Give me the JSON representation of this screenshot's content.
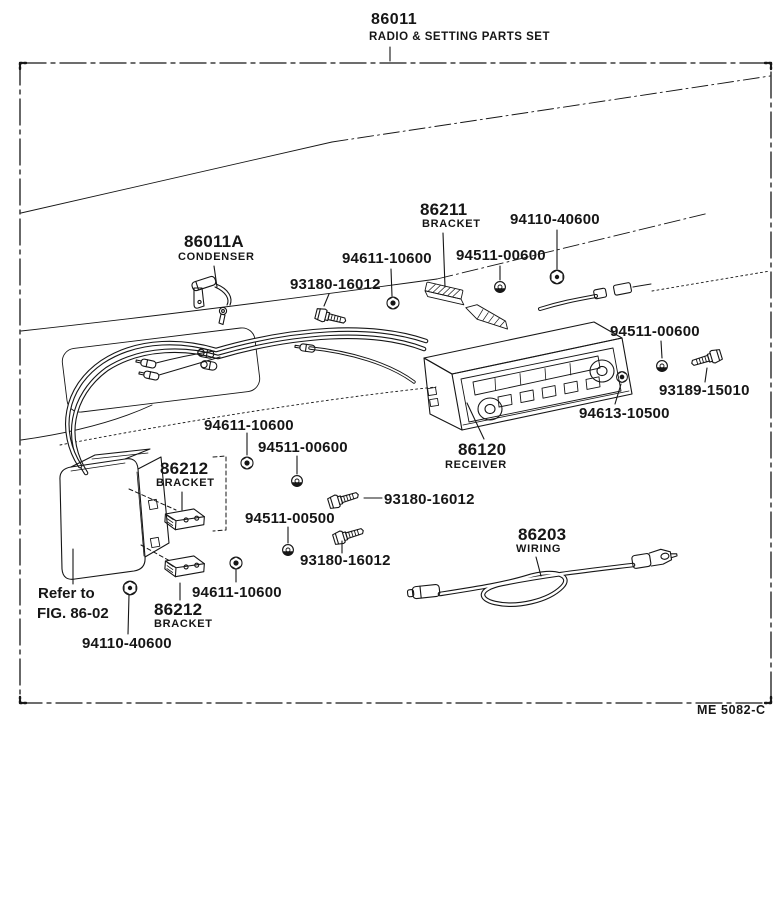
{
  "title": {
    "part_number": "86011",
    "description": "RADIO & SETTING PARTS SET"
  },
  "note": {
    "line1": "Refer to",
    "line2": "FIG. 86-02"
  },
  "drawing_code": "ME 5082-C",
  "callouts": {
    "condenser": {
      "part_number": "86011A",
      "caption": "CONDENSER"
    },
    "bracket_upper": {
      "part_number": "86211",
      "caption": "BRACKET"
    },
    "nut_upper_94110": {
      "part_number": "94110-40600"
    },
    "nut_upper_94611": {
      "part_number": "94611-10600"
    },
    "screw_upper_94511": {
      "part_number": "94511-00600"
    },
    "bolt_upper_93180": {
      "part_number": "93180-16012"
    },
    "screw_right_94511": {
      "part_number": "94511-00600"
    },
    "bolt_right_93189": {
      "part_number": "93189-15010"
    },
    "nut_right_94613": {
      "part_number": "94613-10500"
    },
    "receiver": {
      "part_number": "86120",
      "caption": "RECEIVER"
    },
    "nut_mid_94611": {
      "part_number": "94611-10600"
    },
    "screw_mid_94511": {
      "part_number": "94511-00600"
    },
    "bracket_mid": {
      "part_number": "86212",
      "caption": "BRACKET"
    },
    "bolt_mid_93180": {
      "part_number": "93180-16012"
    },
    "screw_mid_94511_00500": {
      "part_number": "94511-00500"
    },
    "bolt_lower_93180": {
      "part_number": "93180-16012"
    },
    "wiring": {
      "part_number": "86203",
      "caption": "WIRING"
    },
    "nut_lower_94611": {
      "part_number": "94611-10600"
    },
    "bracket_lower": {
      "part_number": "86212",
      "caption": "BRACKET"
    },
    "nut_lower_94110": {
      "part_number": "94110-40600"
    }
  },
  "colors": {
    "ink": "#161616",
    "paper": "#ffffff"
  }
}
